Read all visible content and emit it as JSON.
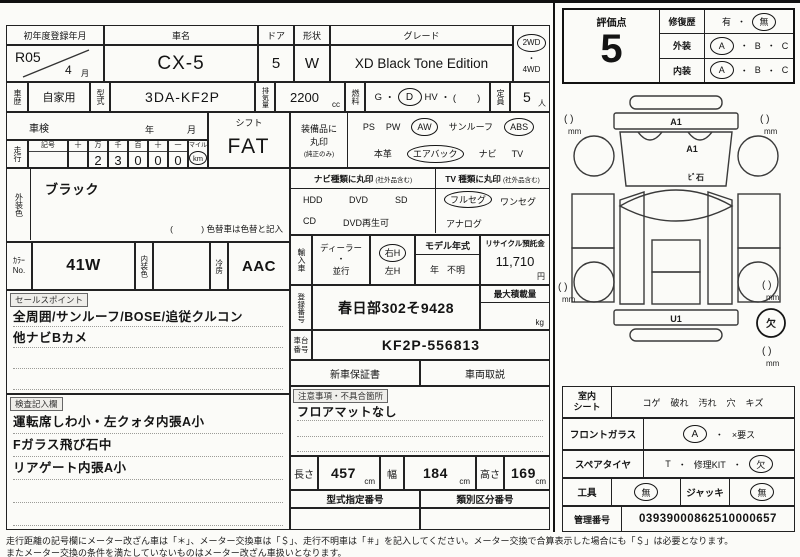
{
  "header": {
    "reg_label": "初年度登録年月",
    "reg_year": "R05",
    "reg_month": "4",
    "reg_month_unit": "月",
    "name_label": "車名",
    "name_value": "CX-5",
    "door_label": "ドア",
    "door_value": "5",
    "shape_label": "形状",
    "shape_value": "W",
    "grade_label": "グレード",
    "grade_value": "XD Black Tone Edition",
    "drive_2wd": "2WD",
    "drive_dot": "・",
    "drive_4wd": "4WD"
  },
  "spec": {
    "history_label": "車歴",
    "history_value": "自家用",
    "model_label": "型式",
    "model_value": "3DA-KF2P",
    "disp_label": "排気量",
    "disp_value": "2200",
    "disp_unit": "cc",
    "fuel_label": "燃料",
    "fuel_g": "G",
    "dot": "・",
    "fuel_d": "D",
    "fuel_hv": "HV",
    "fuel_paren": "・ (        )",
    "cap_label": "定員",
    "cap_value": "5",
    "cap_unit": "人"
  },
  "shaken": {
    "label": "車検",
    "year_unit": "年",
    "month_unit": "月"
  },
  "mileage": {
    "label": "走行",
    "sym_label": "記号",
    "col_headers": [
      "十",
      "万",
      "千",
      "百",
      "十",
      "一"
    ],
    "digits": [
      "",
      "2",
      "3",
      "0",
      "0",
      "0"
    ],
    "mile_label": "マイル",
    "km_label": "km"
  },
  "shift": {
    "label": "シフト",
    "value": "FAT"
  },
  "equipment": {
    "label_line1": "装備品に",
    "label_line2": "丸印",
    "label_note": "(純正のみ)",
    "ps": "PS",
    "pw": "PW",
    "aw": "AW",
    "sunroof": "サンルーフ",
    "abs": "ABS",
    "leather": "本革",
    "airbag": "エアバック",
    "navi": "ナビ",
    "tv": "TV"
  },
  "ext_color": {
    "label": "外装色",
    "value": "ブラック",
    "note": "(            ) 色替車は色替と記入"
  },
  "nav_type": {
    "header": "ナビ種類に丸印",
    "header_note": "(社外品含む)",
    "hdd": "HDD",
    "dvd": "DVD",
    "sd": "SD",
    "cd": "CD",
    "dvd_play": "DVD再生可"
  },
  "tv_type": {
    "header": "TV 種類に丸印",
    "header_note": "(社外品含む)",
    "full_seg": "フルセグ",
    "one_seg": "ワンセグ",
    "analog": "アナログ"
  },
  "color_row": {
    "label_kana": "ｶﾗｰ",
    "label_no": "No.",
    "color_value": "41W",
    "interior_label": "内装色",
    "interior_value": "",
    "ac_label": "冷房",
    "ac_value": "AAC"
  },
  "import_row": {
    "label": "輸入車",
    "dealer": "ディーラー",
    "dot": "・",
    "parallel": "並行",
    "right_h": "右H",
    "left_h": "左H",
    "model_year_label": "モデル年式",
    "year_unit": "年",
    "year_value": "不明",
    "recycle_label": "リサイクル預託金",
    "recycle_value": "11,710",
    "recycle_unit": "円"
  },
  "registration": {
    "label": "登録番号",
    "value": "春日部302そ9428",
    "payload_label": "最大積載量",
    "payload_unit": "kg"
  },
  "chassis": {
    "label1": "車台",
    "label2": "番号",
    "value": "KF2P-556813"
  },
  "docs": {
    "warranty": "新車保証書",
    "manual": "車両取説"
  },
  "notes": {
    "label": "注意事項・不具合箇所",
    "line1": "フロアマットなし"
  },
  "sales": {
    "label": "セールスポイント",
    "line1": "全周囲/サンルーフ/BOSE/追従クルコン",
    "line2": "他ナビBカメ"
  },
  "check": {
    "label": "検査記入欄",
    "line1": "運転席しわ小・左クォタ内張A小",
    "line2": "Fガラス飛び石中",
    "line3": "リアゲート内張A小"
  },
  "dims": {
    "len_label": "長さ",
    "len_value": "457",
    "len_unit": "cm",
    "wid_label": "幅",
    "wid_value": "184",
    "wid_unit": "cm",
    "hgt_label": "高さ",
    "hgt_value": "169",
    "hgt_unit": "cm"
  },
  "type_row": {
    "type_label": "型式指定番号",
    "class_label": "類別区分番号"
  },
  "eval": {
    "score_label": "評価点",
    "score": "5",
    "repair_label": "修復歴",
    "yes": "有",
    "dot": "・",
    "no": "無",
    "ext_label": "外装",
    "int_label": "内装",
    "a": "A",
    "b": "B",
    "c": "C"
  },
  "diagram": {
    "a1_front": "A1",
    "a1_glass": "A1",
    "stone": "ﾋﾞ石",
    "u1": "U1",
    "missing": "欠",
    "paren": "(  )",
    "mm": "mm"
  },
  "seat": {
    "label1": "室内",
    "label2": "シート",
    "items": [
      "コゲ",
      "破れ",
      "汚れ",
      "穴",
      "キズ"
    ]
  },
  "windshield": {
    "label": "フロントガラス",
    "a": "A",
    "dot": "・",
    "x": "×要ス"
  },
  "spare": {
    "label": "スペアタイヤ",
    "t": "T",
    "dot": "・",
    "kit": "修理KIT",
    "missing": "欠"
  },
  "tools": {
    "label": "工具",
    "none1": "無",
    "jack_label": "ジャッキ",
    "none2": "無"
  },
  "admin": {
    "label": "管理番号",
    "value": "03939000862510000657"
  },
  "footer": {
    "line1": "走行距離の記号欄にメーター改ざん車は「＊」、メーター交換車は「＄」、走行不明車は「＃」を記入してください。メーター交換で合算表示した場合にも「＄」は必要となります。",
    "line2": "またメーター交換の条件を満たしていないものはメーター改ざん車扱いとなります。"
  }
}
